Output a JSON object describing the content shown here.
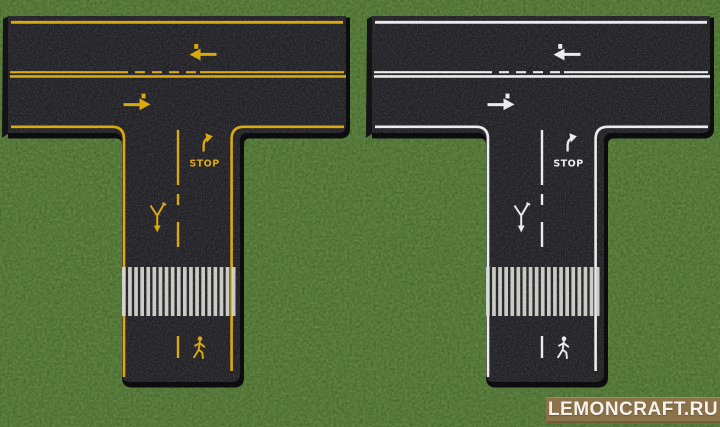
{
  "watermark": {
    "text": "LEMONCRAFT.RU"
  },
  "road_markings": {
    "stop_label": "STOP"
  },
  "colors": {
    "grass": "#5a7a3c",
    "asphalt": "#232327",
    "edge": "#0d0d10",
    "side": "#141416",
    "mark_yellow": "#d9a90e",
    "mark_white": "#ebebeb",
    "zebra": "#d8d8d4",
    "wm_bg": "#8b7349",
    "wm_text": "#f5f1ec"
  },
  "roads": [
    {
      "id": "road-yellow-marked",
      "marking_color_key": "mark_yellow"
    },
    {
      "id": "road-white-marked",
      "marking_color_key": "mark_white"
    }
  ]
}
